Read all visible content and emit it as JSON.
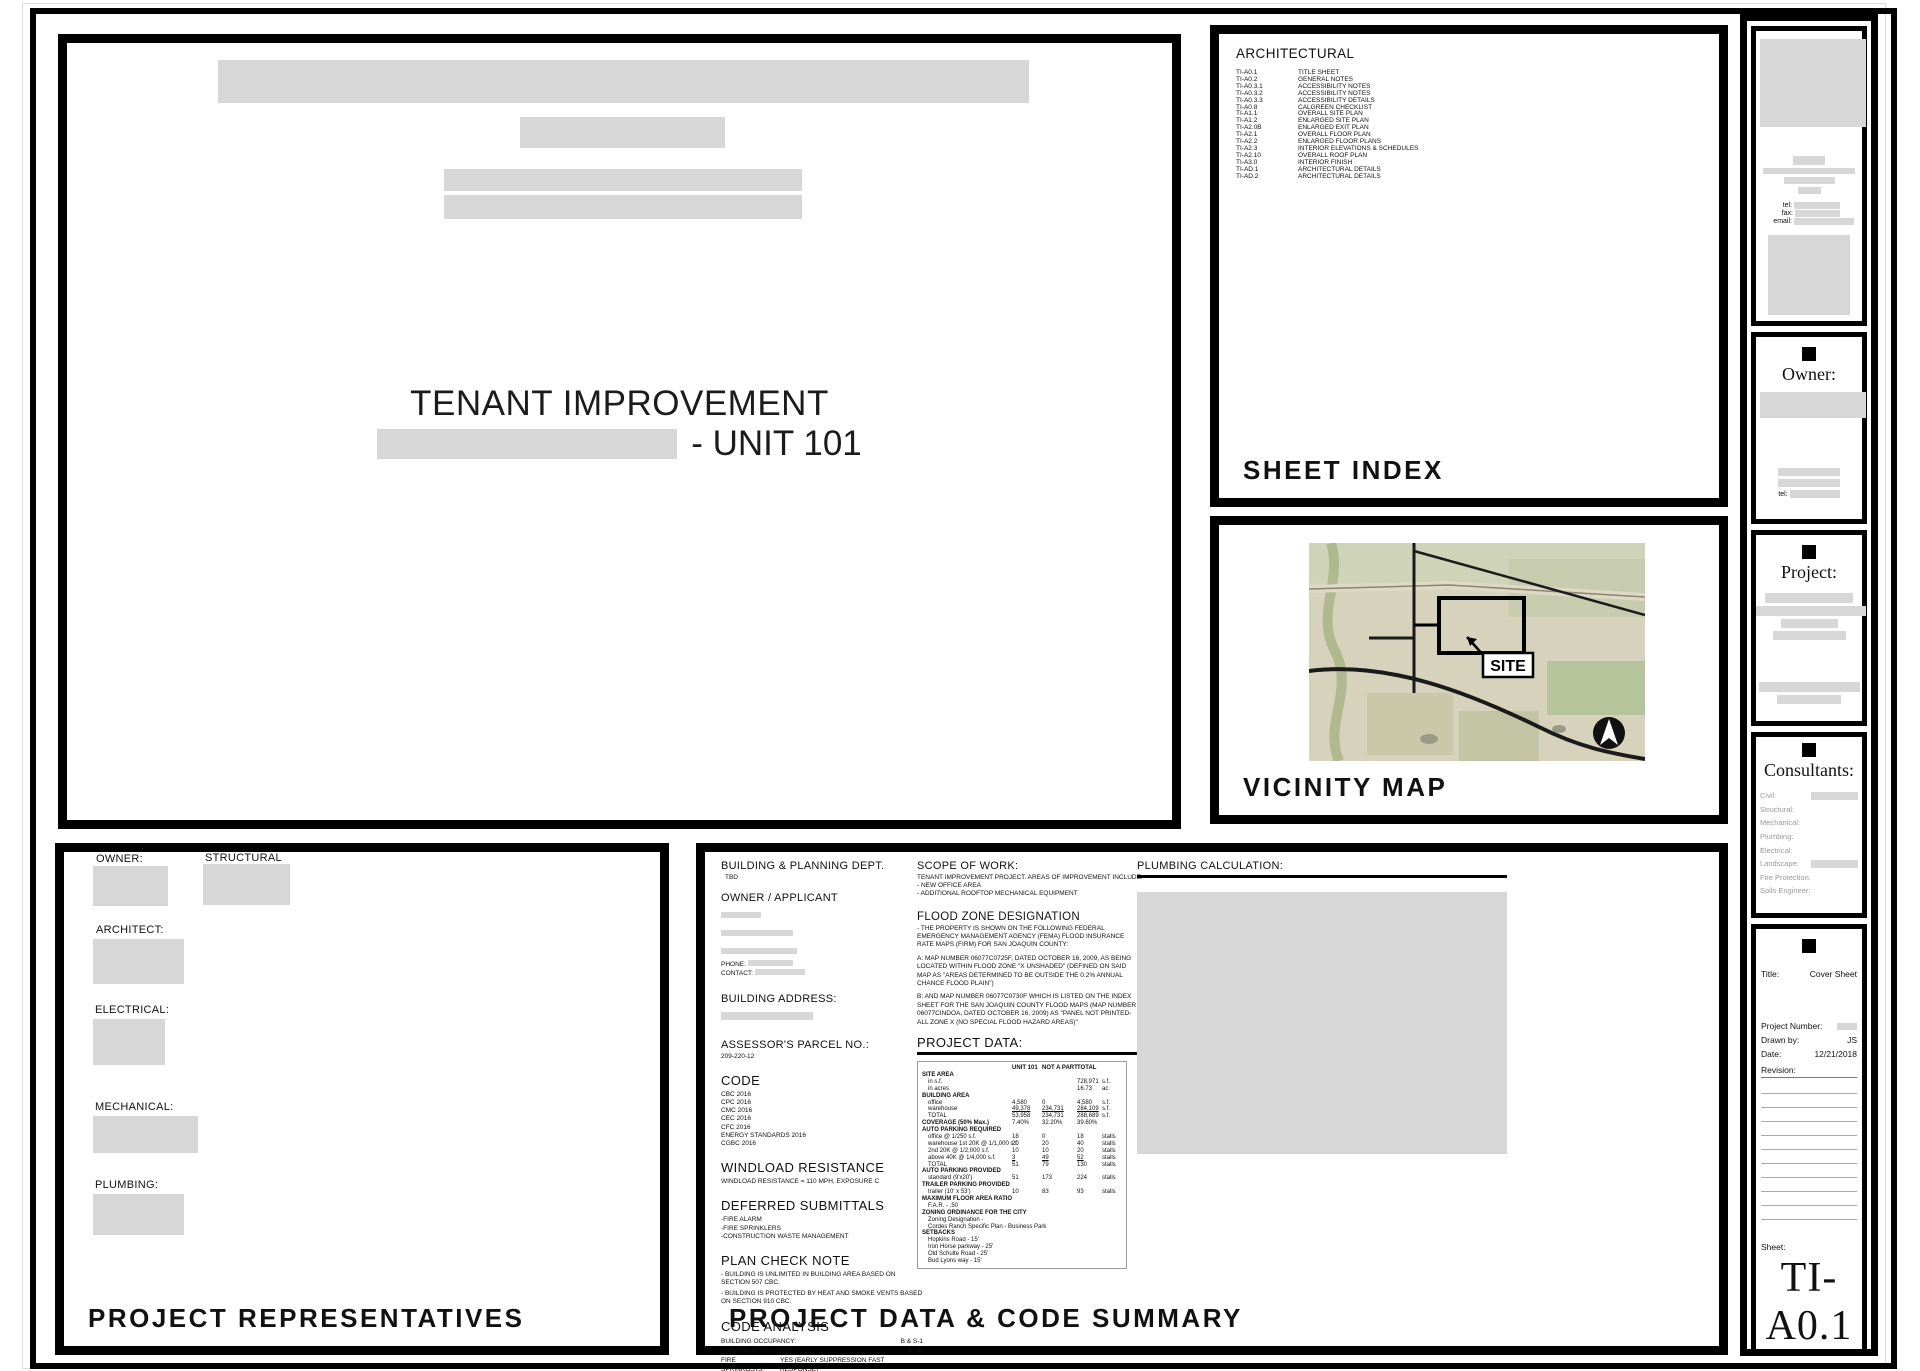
{
  "cover": {
    "title": "TENANT IMPROVEMENT",
    "unit_suffix": "- UNIT 101"
  },
  "sheet_index": {
    "panel_title": "SHEET INDEX",
    "discipline_heading": "ARCHITECTURAL",
    "sheets": [
      {
        "no": "TI-A0.1",
        "name": "TITLE SHEET"
      },
      {
        "no": "TI-A0.2",
        "name": "GENERAL NOTES"
      },
      {
        "no": "TI-A0.3.1",
        "name": "ACCESSIBILITY NOTES"
      },
      {
        "no": "TI-A0.3.2",
        "name": "ACCESSIBILITY NOTES"
      },
      {
        "no": "TI-A0.3.3",
        "name": "ACCESSIBILITY DETAILS"
      },
      {
        "no": "TI-A0.8",
        "name": "CALGREEN CHECKLIST"
      },
      {
        "no": "TI-A1.1",
        "name": "OVERALL SITE PLAN"
      },
      {
        "no": "TI-A1.2",
        "name": "ENLARGED SITE PLAN"
      },
      {
        "no": "TI-A2.0B",
        "name": "ENLARGED EXIT PLAN"
      },
      {
        "no": "TI-A2.1",
        "name": "OVERALL FLOOR PLAN"
      },
      {
        "no": "TI-A2.2",
        "name": "ENLARGED FLOOR PLANS"
      },
      {
        "no": "TI-A2.3",
        "name": "INTERIOR ELEVATIONS & SCHEDULES"
      },
      {
        "no": "TI-A2.10",
        "name": "OVERALL ROOF PLAN"
      },
      {
        "no": "TI-A3.0",
        "name": "INTERIOR FINISH"
      },
      {
        "no": "TI-AD.1",
        "name": "ARCHITECTURAL DETAILS"
      },
      {
        "no": "TI-AD.2",
        "name": "ARCHITECTURAL DETAILS"
      }
    ]
  },
  "vicinity_map": {
    "panel_title": "VICINITY MAP",
    "site_label": "SITE",
    "north": "N"
  },
  "representatives": {
    "panel_title": "PROJECT REPRESENTATIVES",
    "labels": [
      "OWNER:",
      "STRUCTURAL",
      "ARCHITECT:",
      "ELECTRICAL:",
      "MECHANICAL:",
      "PLUMBING:"
    ]
  },
  "data_panel": {
    "panel_title": "PROJECT DATA & CODE SUMMARY",
    "building_dept": {
      "heading": "BUILDING & PLANNING DEPT.",
      "value": "TBD"
    },
    "owner_applicant": {
      "heading": "OWNER / APPLICANT",
      "phone_label": "PHONE:",
      "contact_label": "CONTACT:"
    },
    "building_address": {
      "heading": "BUILDING ADDRESS:"
    },
    "apn": {
      "heading": "ASSESSOR'S PARCEL NO.:",
      "value": "209-220-12"
    },
    "code": {
      "heading": "CODE",
      "items": [
        "CBC 2016",
        "CPC 2016",
        "CMC 2016",
        "CEC 2016",
        "CFC 2016",
        "ENERGY STANDARDS 2016",
        "CGBC 2016"
      ]
    },
    "windload": {
      "heading": "WINDLOAD RESISTANCE",
      "body": "WINDLOAD RESISTANCE =  110 MPH, EXPOSURE C"
    },
    "deferred": {
      "heading": "DEFERRED SUBMITTALS",
      "items": [
        "-FIRE ALARM",
        "-FIRE SPRINKLERS",
        "-CONSTRUCTION WASTE MANAGEMENT"
      ]
    },
    "plan_check": {
      "heading": "PLAN CHECK NOTE",
      "items": [
        "- BUILDING IS UNLIMITED IN BUILDING AREA BASED ON SECTION 507 CBC.",
        "- BUILDING IS PROTECTED BY HEAT AND SMOKE VENTS BASED ON SECTION 910 CBC."
      ]
    },
    "code_analysis": {
      "heading": "CODE ANALYSIS",
      "rows": [
        {
          "label": "BUILDING OCCUPANCY:",
          "value": "B & S-1"
        },
        {
          "label": "CONSTRUCTION TYPE:",
          "value": "III - B"
        },
        {
          "label": "FIRE SPRINKLERS:",
          "value": "YES (EARLY SUPPRESSION FAST RESPONSE)"
        }
      ]
    },
    "scope": {
      "heading": "SCOPE OF WORK:",
      "lines": [
        "TENANT IMPROVEMENT PROJECT. AREAS OF IMPROVEMENT INCLUDE:",
        "- NEW OFFICE AREA",
        "- ADDITIONAL ROOFTOP MECHANICAL EQUIPMENT"
      ]
    },
    "flood": {
      "heading": "FLOOD ZONE DESIGNATION",
      "paragraphs": [
        "- THE PROPERTY IS SHOWN ON THE FOLLOWING FEDERAL EMERGENCY MANAGEMENT AGENCY (FEMA) FLOOD INSURANCE RATE MAPS (FIRM) FOR SAN JOAQUIN COUNTY:",
        "A:    MAP NUMBER 06077C0725F, DATED OCTOBER 16, 2009, AS BEING LOCATED WITHIN FLOOD ZONE \"X UNSHADED\" (DEFINED ON SAID MAP AS \"AREAS DETERMINED TO BE OUTSIDE THE 0.2% ANNUAL CHANCE FLOOD PLAIN\")",
        "B:    AND MAP NUMBER 06077C0730F WHICH IS LISTED ON THE INDEX SHEET FOR THE SAN JOAQUIN COUNTY FLOOD MAPS (MAP NUMBER 06077CINDOA, DATED OCTOBER 16, 2009) AS \"PANEL NOT PRINTED-ALL ZONE X (NO SPECIAL FLOOD HAZARD AREAS)\""
      ]
    },
    "project_data": {
      "heading": "PROJECT DATA:",
      "col_headers": [
        "UNIT 101",
        "NOT A PART",
        "TOTAL"
      ],
      "rows": [
        {
          "label": "SITE AREA",
          "cls": "section"
        },
        {
          "label": "in s.f.",
          "t": "728,971",
          "unit": "s.f.",
          "cls": "item"
        },
        {
          "label": "in acres",
          "t": "16.73",
          "unit": "ac",
          "cls": "item"
        },
        {
          "label": "BUILDING AREA",
          "cls": "section"
        },
        {
          "label": "office",
          "u": "4,580",
          "n": "0",
          "t": "4,580",
          "unit": "s.f.",
          "cls": "item"
        },
        {
          "label": "warehouse",
          "u": "49,378",
          "n": "234,731",
          "t": "284,109",
          "unit": "s.f.",
          "cls": "item underline"
        },
        {
          "label": "TOTAL",
          "u": "53,958",
          "n": "234,731",
          "t": "288,689",
          "unit": "s.f.",
          "cls": "item"
        },
        {
          "label": "COVERAGE (50% Max.)",
          "u": "7.40%",
          "n": "32.20%",
          "t": "39.60%",
          "cls": "section"
        },
        {
          "label": "AUTO PARKING REQUIRED",
          "cls": "section"
        },
        {
          "label": "office @ 1/250 s.f.",
          "u": "18",
          "n": "0",
          "t": "18",
          "unit": "stalls",
          "cls": "item"
        },
        {
          "label": "warehouse 1st 20K @ 1/1,000 s.f.",
          "u": "20",
          "n": "20",
          "t": "40",
          "unit": "stalls",
          "cls": "item"
        },
        {
          "label": "2nd 20K @ 1/2,000 s.f.",
          "u": "10",
          "n": "10",
          "t": "20",
          "unit": "stalls",
          "cls": "item"
        },
        {
          "label": "above 40K @ 1/4,000 s.f.",
          "u": "3",
          "n": "49",
          "t": "52",
          "unit": "stalls",
          "cls": "item underline"
        },
        {
          "label": "TOTAL",
          "u": "51",
          "n": "79",
          "t": "130",
          "unit": "stalls",
          "cls": "item"
        },
        {
          "label": "AUTO PARKING PROVIDED",
          "cls": "section"
        },
        {
          "label": "standard (9'x20')",
          "u": "51",
          "n": "173",
          "t": "224",
          "unit": "stalls",
          "cls": "item"
        },
        {
          "label": "TRAILER PARKING PROVIDED",
          "cls": "section"
        },
        {
          "label": "trailer (10' x 53')",
          "u": "10",
          "n": "83",
          "t": "93",
          "unit": "stalls",
          "cls": "item"
        },
        {
          "label": "MAXIMUM FLOOR AREA RATIO",
          "cls": "section"
        },
        {
          "label": "F.A.R. - .50",
          "cls": "item"
        },
        {
          "label": "ZONING ORDINANCE FOR THE CITY",
          "cls": "section"
        },
        {
          "label": "Zoning Designation -",
          "cls": "item"
        },
        {
          "label": "Cordes Ranch Specific Plan - Business Park",
          "cls": "item"
        },
        {
          "label": "SETBACKS",
          "cls": "section"
        },
        {
          "label": "Hopkins Road - 15'",
          "cls": "item"
        },
        {
          "label": "Iron Horse parkway - 25'",
          "cls": "item"
        },
        {
          "label": "Old Schulte Road - 25'",
          "cls": "item"
        },
        {
          "label": "Bud Lyons way - 15'",
          "cls": "item"
        }
      ]
    },
    "plumbing": {
      "heading": "PLUMBING CALCULATION:"
    }
  },
  "title_block": {
    "tel_label": "tel:",
    "fax_label": "fax:",
    "email_label": "email:",
    "owner_heading": "Owner:",
    "owner_tel_label": "tel:",
    "project_heading": "Project:",
    "consultants_heading": "Consultants:",
    "consultants": [
      {
        "label": "Civil:"
      },
      {
        "label": "Structural:"
      },
      {
        "label": "Mechanical:"
      },
      {
        "label": "Plumbing:"
      },
      {
        "label": "Electrical:"
      },
      {
        "label": "Landscape:"
      },
      {
        "label": "Fire Protection:"
      },
      {
        "label": "Soils Engineer:"
      }
    ],
    "title_label": "Title:",
    "title_value": "Cover Sheet",
    "project_number_label": "Project Number:",
    "drawn_by_label": "Drawn by:",
    "drawn_by_value": "JS",
    "date_label": "Date:",
    "date_value": "12/21/2018",
    "revision_label": "Revision:",
    "sheet_label": "Sheet:",
    "sheet_value": "TI-A0.1"
  },
  "colors": {
    "redacted": "#d7d7d7",
    "ink": "#111111",
    "map_land": "#d6d2bc"
  }
}
